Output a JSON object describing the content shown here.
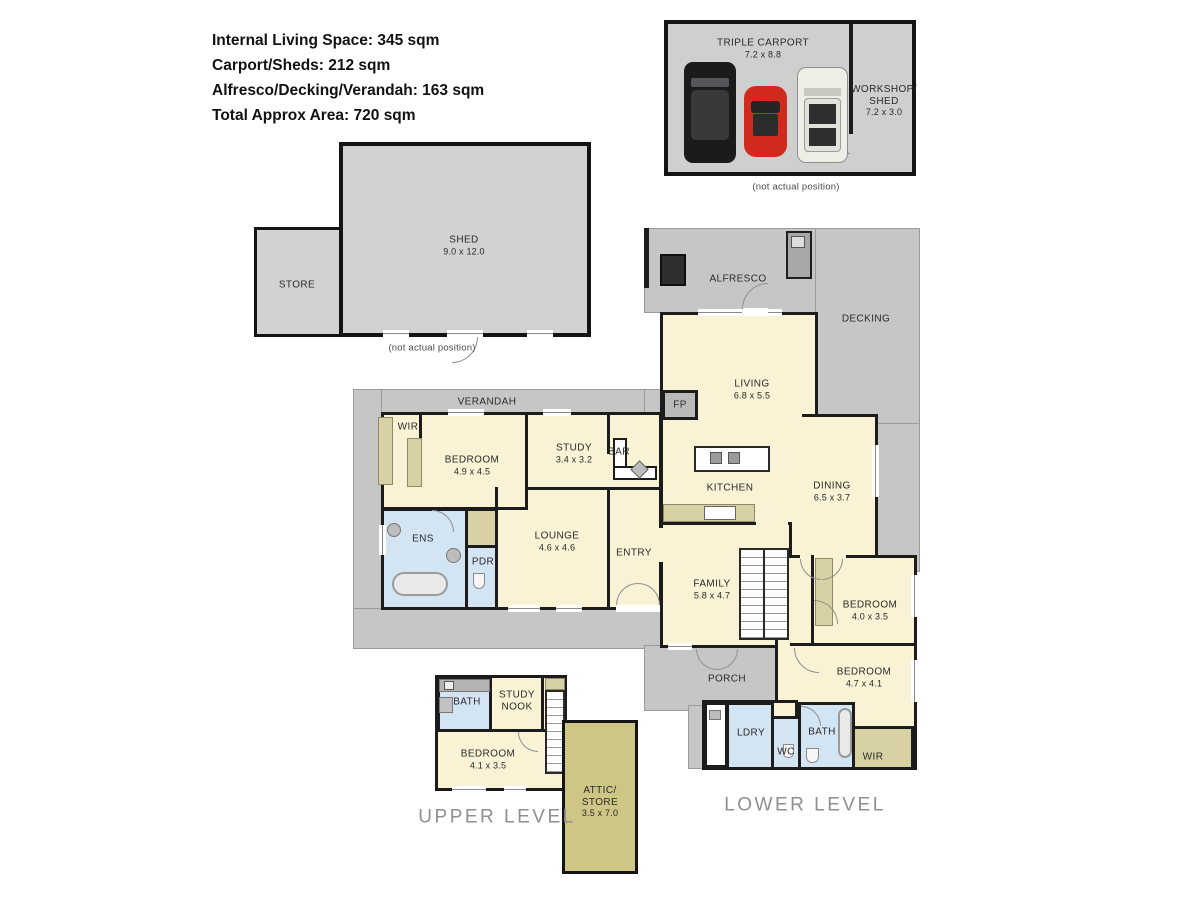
{
  "colors": {
    "floor_cream": "#f9f2d4",
    "wet_blue": "#d3e4f3",
    "cabinet_tan": "#d8d1a4",
    "attic_khaki": "#cdc685",
    "outdoor_gray": "#c6c6c6",
    "wall_black": "#1c1c1c",
    "car_red": "#cf2a1d",
    "car_black": "#1b1b1d",
    "car_white": "#eeede6"
  },
  "stats": {
    "line1": "Internal Living Space: 345 sqm",
    "line2": "Carport/Sheds: 212 sqm",
    "line3": "Alfresco/Decking/Verandah: 163 sqm",
    "line4": "Total Approx Area: 720 sqm"
  },
  "carport": {
    "title": "TRIPLE CARPORT",
    "dims": "7.2 x 8.8",
    "workshop1": "WORKSHOP/",
    "workshop2": "SHED",
    "workshop_dims": "7.2 x 3.0",
    "note": "(not actual position)"
  },
  "shed": {
    "name": "SHED",
    "dims": "9.0 x 12.0",
    "store": "STORE",
    "note": "(not actual position)"
  },
  "lower": {
    "level": "LOWER LEVEL",
    "alfresco": "ALFRESCO",
    "decking": "DECKING",
    "verandah": "VERANDAH",
    "porch": "PORCH",
    "fp": "FP",
    "living": "LIVING",
    "living_dims": "6.8 x 5.5",
    "kitchen": "KITCHEN",
    "dining": "DINING",
    "dining_dims": "6.5 x 3.7",
    "family": "FAMILY",
    "family_dims": "5.8 x 4.7",
    "wir": "WIR",
    "bedroom1": "BEDROOM",
    "bedroom1_dims": "4.9 x 4.5",
    "study": "STUDY",
    "study_dims": "3.4 x 3.2",
    "bar": "BAR",
    "ens": "ENS",
    "pdr": "PDR",
    "lounge": "LOUNGE",
    "lounge_dims": "4.6 x 4.6",
    "entry": "ENTRY",
    "bedroom2": "BEDROOM",
    "bedroom2_dims": "4.0 x 3.5",
    "bedroom3": "BEDROOM",
    "bedroom3_dims": "4.7 x 4.1",
    "ldry": "LDRY",
    "wc": "WC",
    "bath": "BATH",
    "wir2": "WIR"
  },
  "upper": {
    "level": "UPPER LEVEL",
    "bath": "BATH",
    "nook1": "STUDY",
    "nook2": "NOOK",
    "bedroom": "BEDROOM",
    "bedroom_dims": "4.1 x 3.5",
    "attic1": "ATTIC/",
    "attic2": "STORE",
    "attic_dims": "3.5 x 7.0"
  }
}
